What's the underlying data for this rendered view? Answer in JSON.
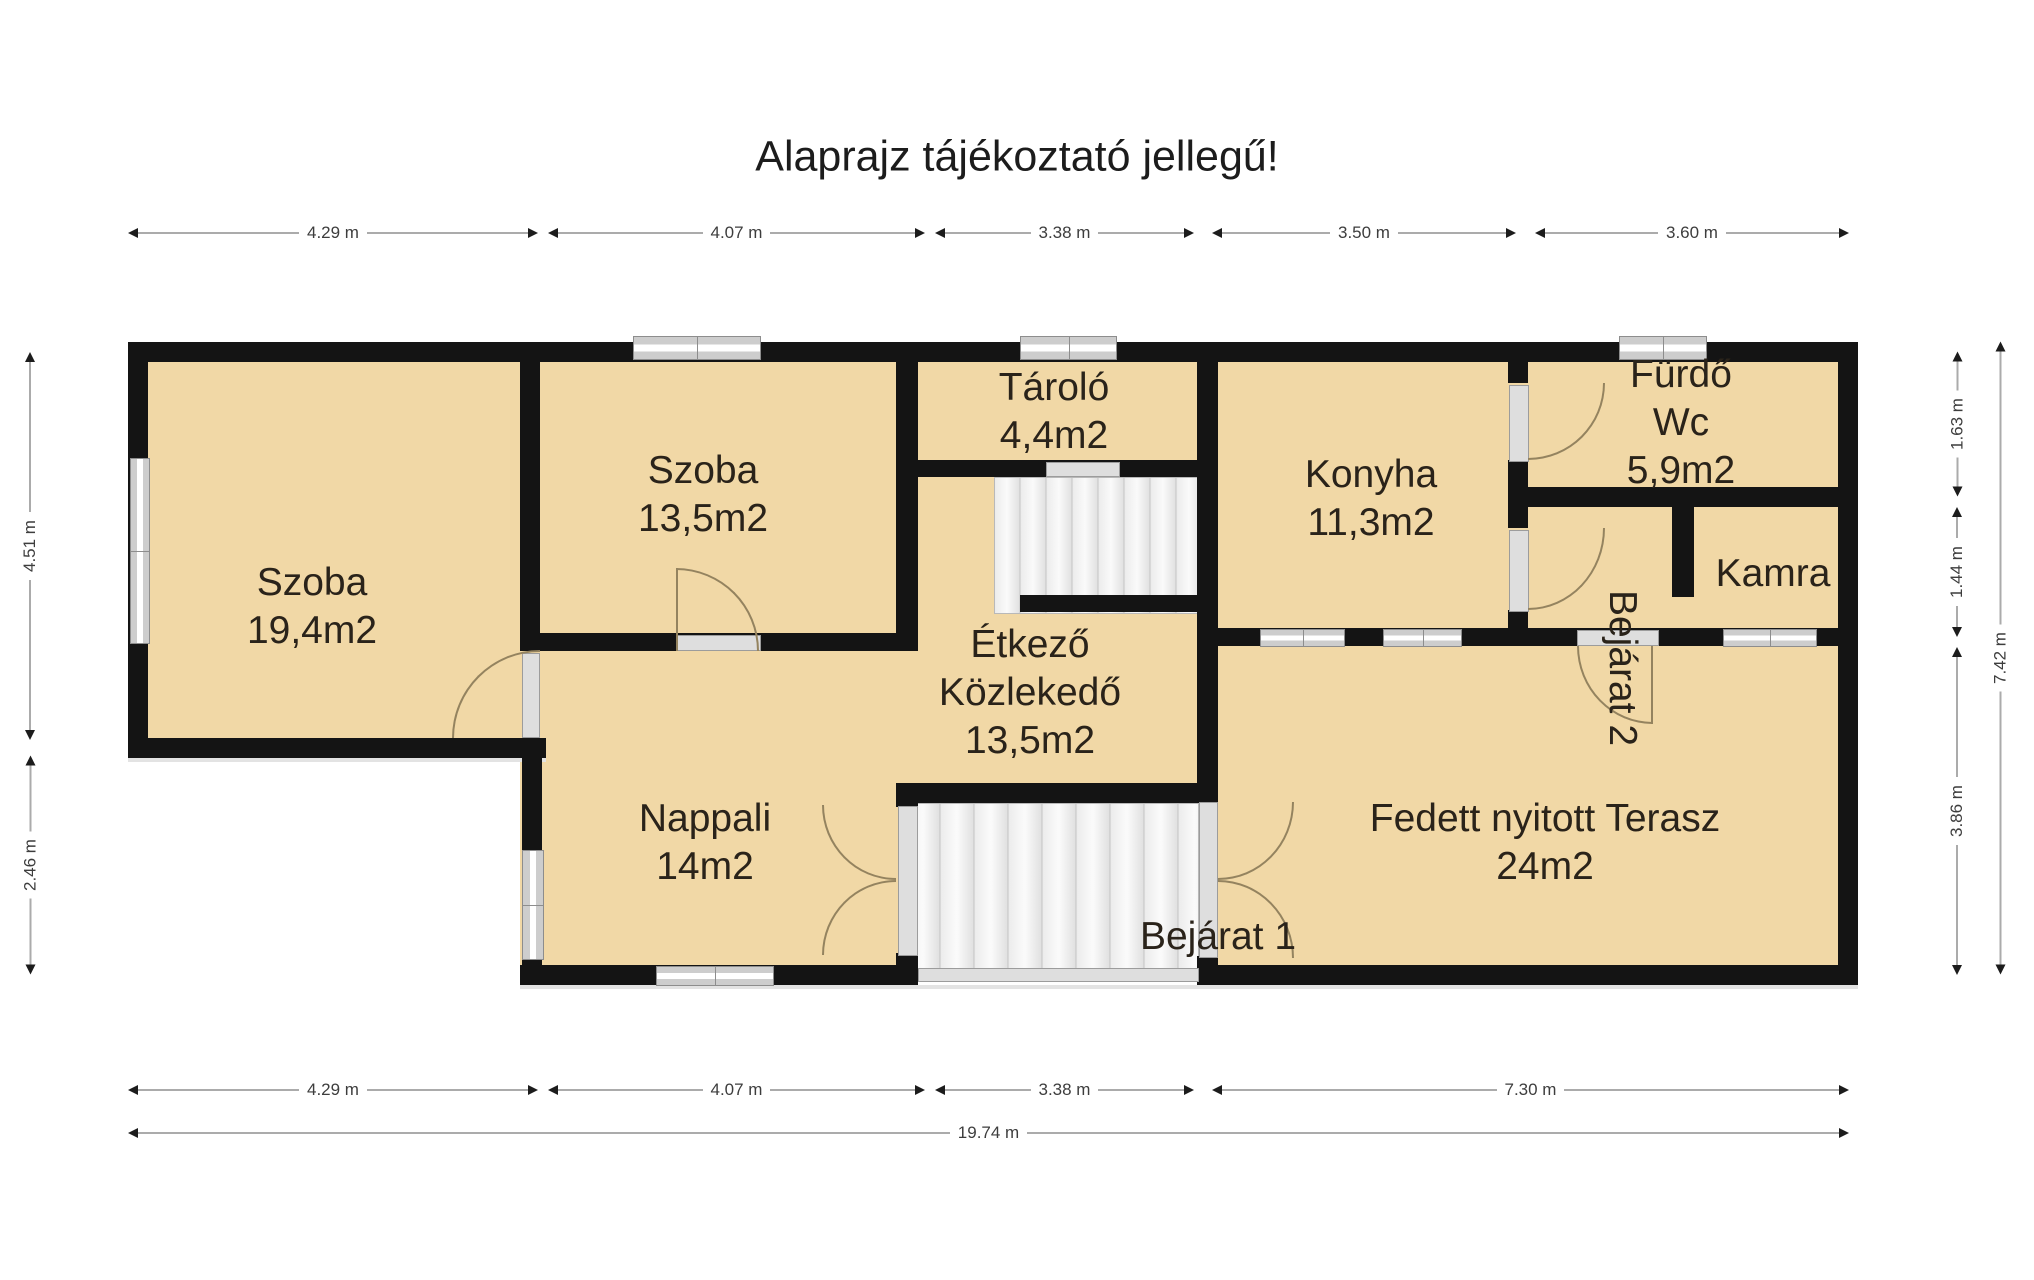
{
  "title": "Alaprajz tájékoztató jellegű!",
  "rooms": {
    "szoba1": {
      "name": "Szoba",
      "area": "19,4m2"
    },
    "szoba2": {
      "name": "Szoba",
      "area": "13,5m2"
    },
    "tarolo": {
      "name": "Tároló",
      "area": "4,4m2"
    },
    "konyha": {
      "name": "Konyha",
      "area": "11,3m2"
    },
    "furdo": {
      "name": "Fürdő",
      "name2": "Wc",
      "area": "5,9m2"
    },
    "kamra": {
      "name": "Kamra"
    },
    "etkezo": {
      "name": "Étkező",
      "name2": "Közlekedő",
      "area": "13,5m2"
    },
    "nappali": {
      "name": "Nappali",
      "area": "14m2"
    },
    "terasz": {
      "name": "Fedett nyitott Terasz",
      "area": "24m2"
    }
  },
  "entrances": {
    "e1": "Bejárat 1",
    "e2": "Bejárat 2"
  },
  "dims": {
    "top": [
      "4.29 m",
      "4.07 m",
      "3.38 m",
      "3.50 m",
      "3.60 m"
    ],
    "bottom": [
      "4.29 m",
      "4.07 m",
      "3.38 m",
      "7.30 m"
    ],
    "bottom_total": "19.74 m",
    "left": [
      "4.51 m",
      "2.46 m"
    ],
    "right": [
      "1.63 m",
      "1.44 m",
      "3.86 m"
    ],
    "right_total": "7.42 m"
  },
  "colors": {
    "floor": "#f1d8a6",
    "wall": "#141414",
    "stairs": "#ececec",
    "window_glass": "#cdcdcd",
    "door_arc": "#94835f",
    "dimension_line": "#ababab",
    "text": "#2a231a"
  }
}
